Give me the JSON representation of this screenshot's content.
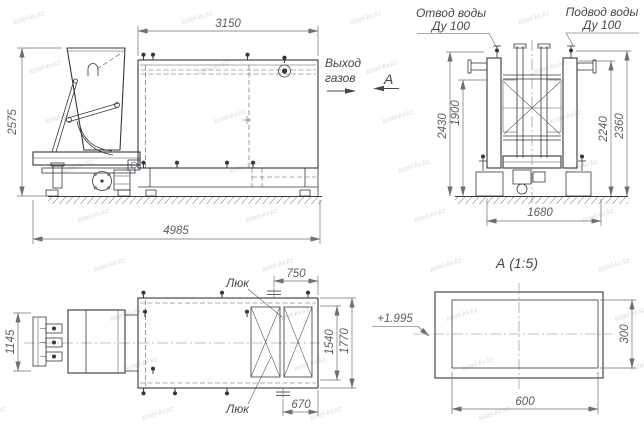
{
  "watermark": {
    "text": "kotel-kv.kz"
  },
  "side_view": {
    "dim_top_width": "3150",
    "dim_height": "2575",
    "dim_overall_length": "4985",
    "gas_outlet_label_line1": "Выход",
    "gas_outlet_label_line2": "газов",
    "view_direction_letter": "А"
  },
  "end_view": {
    "water_drain_label_line1": "Отвод воды",
    "water_drain_label_line2": "Ду 100",
    "water_supply_label_line1": "Подвод воды",
    "water_supply_label_line2": "Ду 100",
    "dim_height_outer_left": "2430",
    "dim_height_inner_left": "1900",
    "dim_height_inner_right": "2240",
    "dim_height_outer_right": "2360",
    "dim_foundation_width": "1680"
  },
  "plan_view": {
    "dim_feeder_width": "1145",
    "dim_top_nozzle_offset": "750",
    "dim_bottom_nozzle_offset": "670",
    "dim_inner_width": "1540",
    "dim_outer_width": "1770",
    "hatch_label_top": "Люк",
    "hatch_label_bottom": "Люк"
  },
  "detail_view": {
    "title": "А (1:5)",
    "dim_width": "600",
    "dim_height": "300",
    "elevation_mark": "+1.995"
  },
  "colors": {
    "background": "#ffffff",
    "line": "#33383d",
    "dimension": "#6a7076",
    "watermark": "#aeb7c1"
  }
}
